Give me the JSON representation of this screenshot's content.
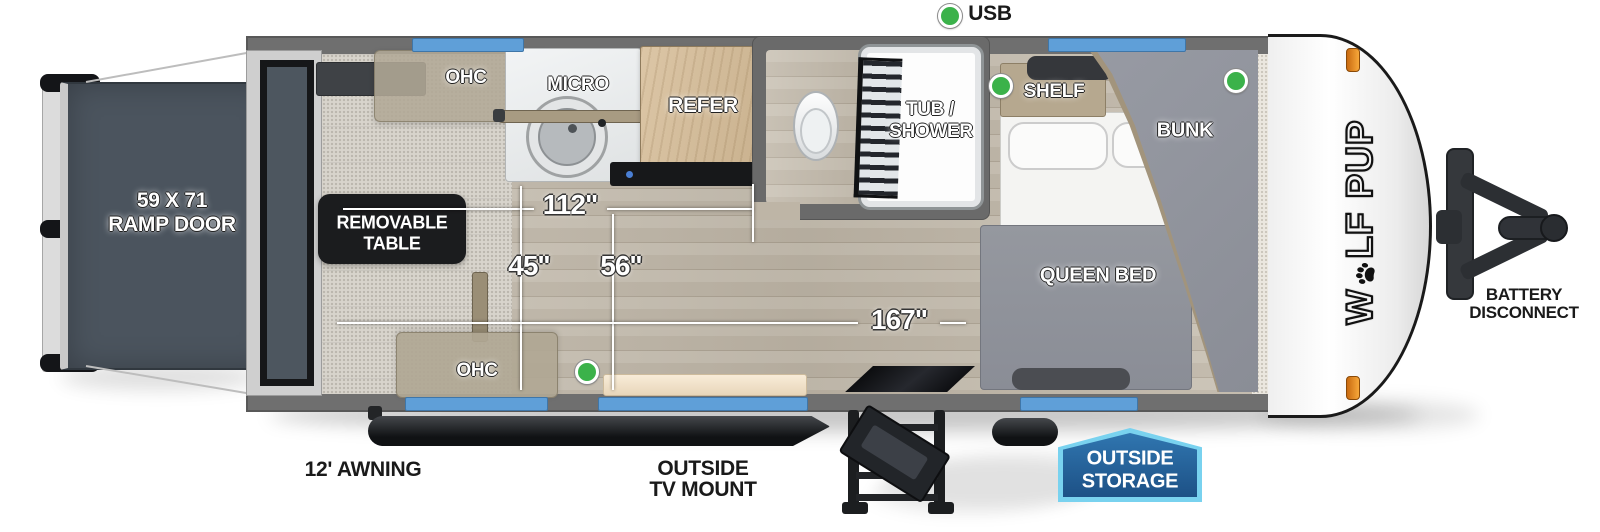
{
  "legend": {
    "usb": "USB"
  },
  "dims": {
    "d112": "112\"",
    "d45": "45\"",
    "d56": "56\"",
    "d167": "167\""
  },
  "interior": {
    "ohc_top": "OHC",
    "micro": "MICRO",
    "refer": "REFER",
    "tub1": "TUB /",
    "tub2": "SHOWER",
    "shelf": "SHELF",
    "bunk": "BUNK",
    "queen": "QUEEN BED",
    "table1": "REMOVABLE",
    "table2": "TABLE",
    "ohc_bottom": "OHC"
  },
  "exterior": {
    "ramp1": "59 X 71",
    "ramp2": "RAMP DOOR",
    "awning": "12' AWNING",
    "tv1": "OUTSIDE",
    "tv2": "TV MOUNT",
    "storage1": "OUTSIDE",
    "storage2": "STORAGE",
    "battery1": "BATTERY",
    "battery2": "DISCONNECT",
    "brand_w": "W",
    "brand_lf": "LF",
    "brand_pup": "PUP"
  },
  "colors": {
    "usb_green": "#3bb24a",
    "window_blue": "#5f9fd8",
    "badge_blue": "#1e5287",
    "badge_border": "#79d2ef",
    "amber": "#f09b2e",
    "wall_gray": "#6f6f6f",
    "ramp_slate": "#4b545e"
  }
}
